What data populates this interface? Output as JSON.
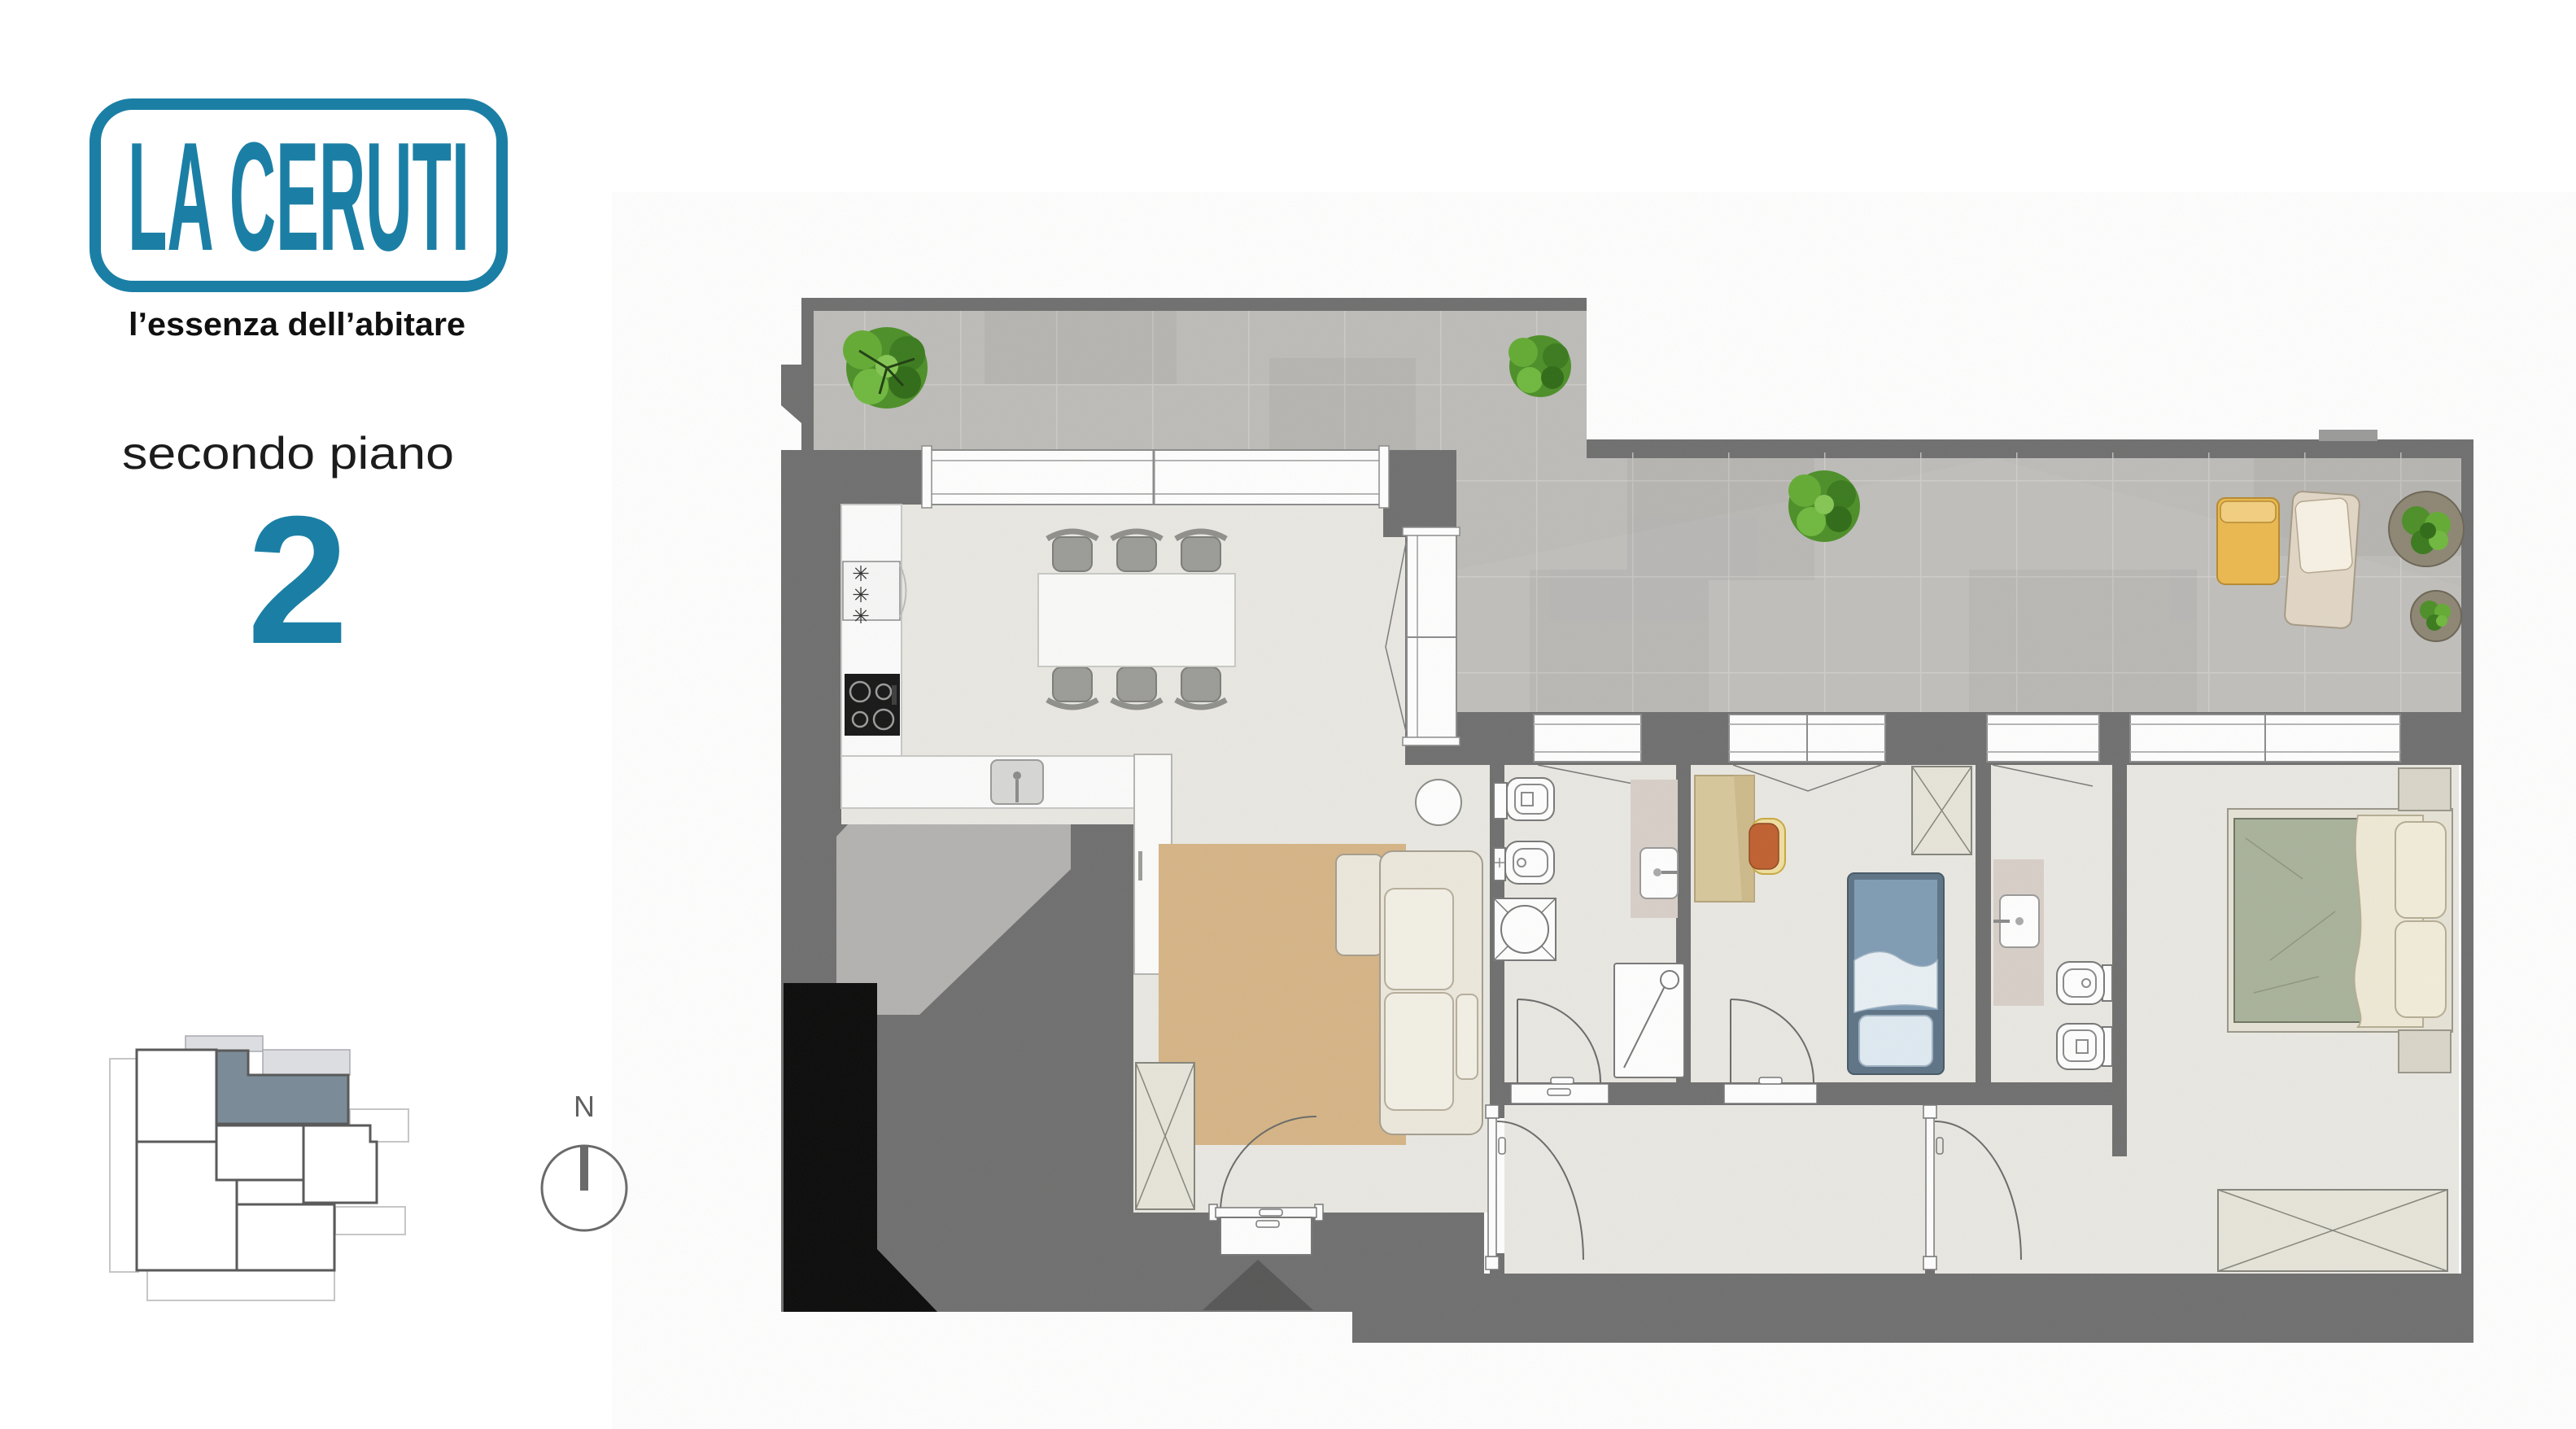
{
  "brand": {
    "logo_text": "LA CERUTI",
    "tagline": "l’essenza dell’abitare"
  },
  "floor": {
    "label": "secondo piano",
    "number": "2"
  },
  "compass": {
    "north_label": "N"
  },
  "kitchen": {
    "fridge_symbol": "✳"
  },
  "palette": {
    "accent_teal": "#1b7fa5",
    "wall_gray": "#6f6f6f",
    "terrace_floor": "#bdbcb9",
    "interior_floor": "#eae8e2",
    "rug_tan": "#d6b586",
    "keyplan_highlight": "#7b8c98",
    "keyplan_light": "#dcdde1",
    "bed_green": "#a9b29b",
    "bed_blue": "#7f9cb4",
    "lounger_yellow": "#ecb94f",
    "tree_green": "#4c8f27",
    "shaft_black": "#0a0a0a"
  }
}
